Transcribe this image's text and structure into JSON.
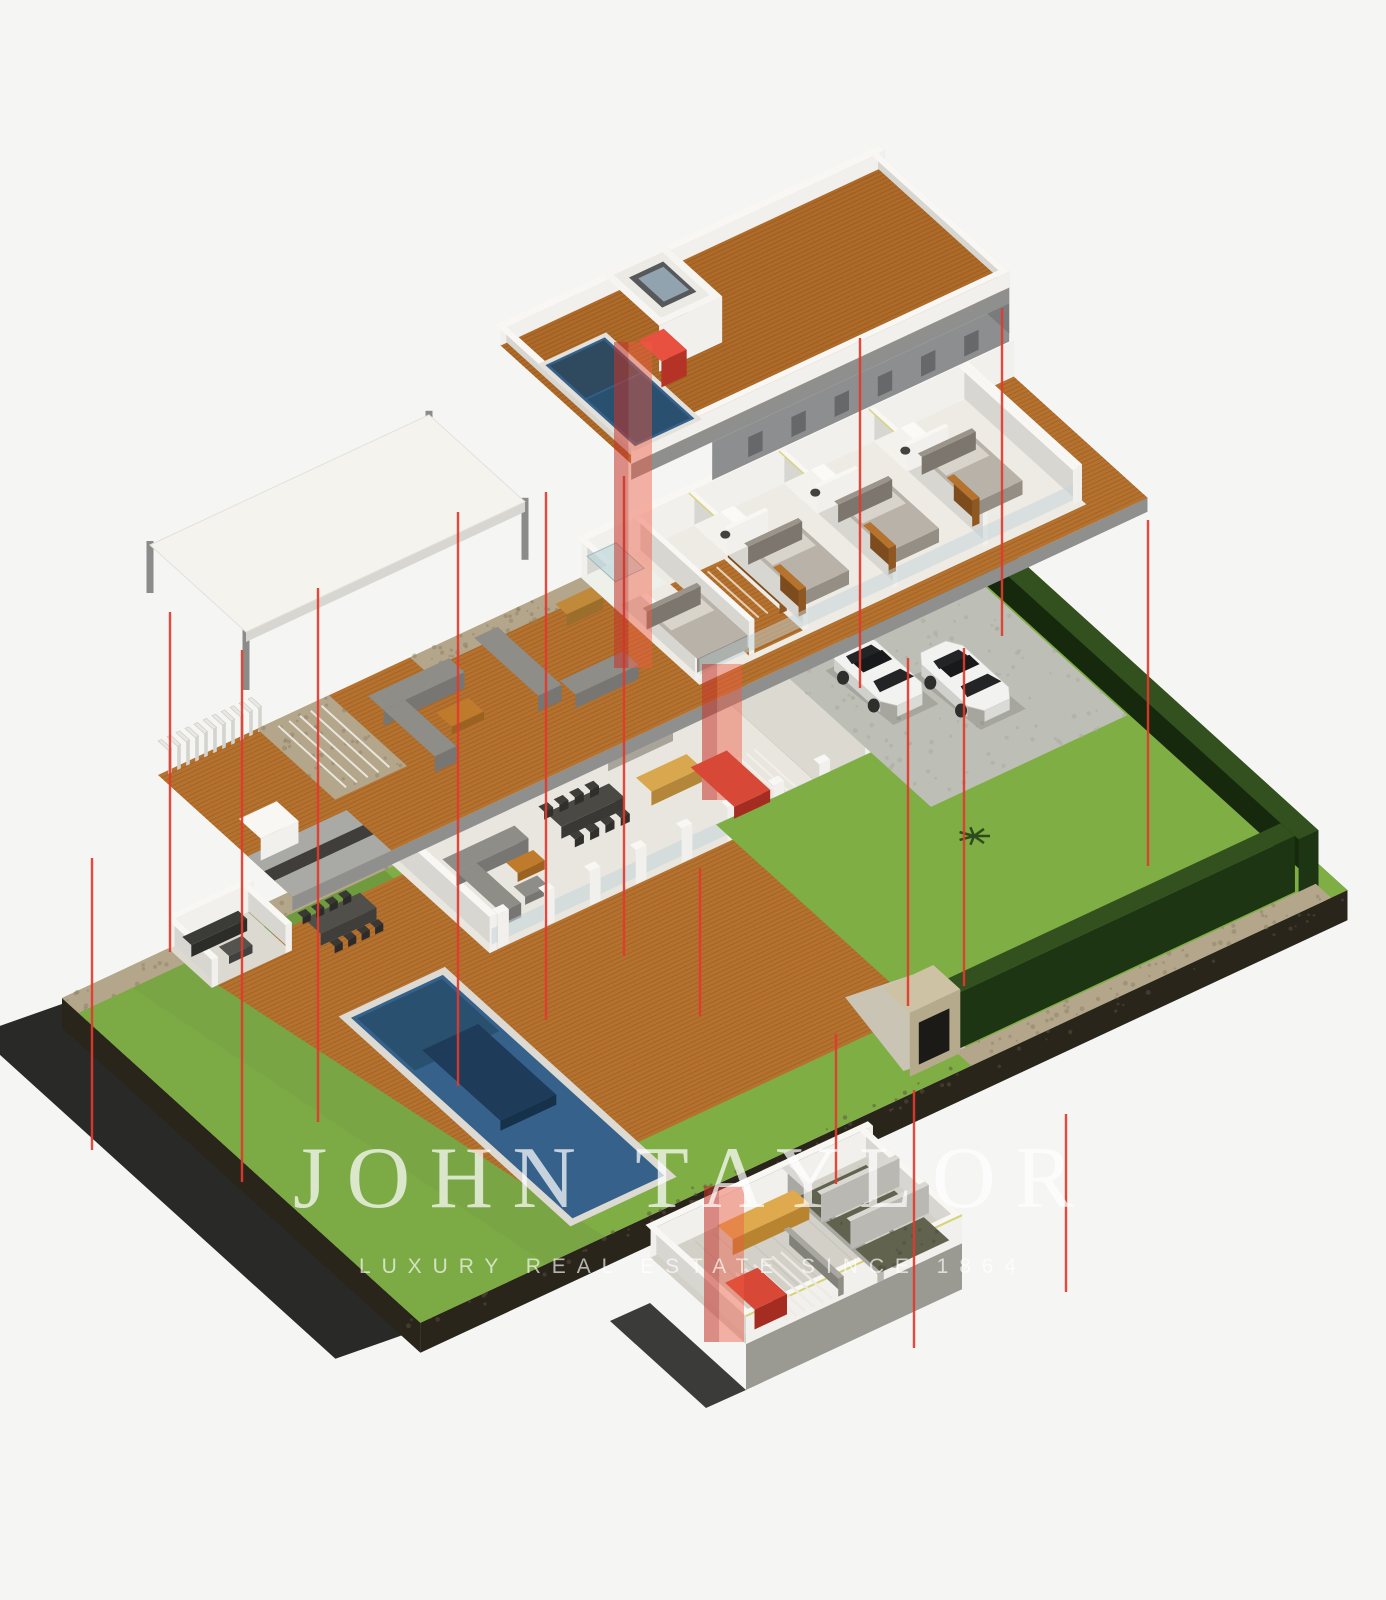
{
  "watermark": {
    "brand": "JOHN TAYLOR",
    "tagline": "LUXURY REAL ESTATE SINCE 1864"
  },
  "colors": {
    "background": "#f5f5f3",
    "red_line": "#e2392b",
    "red_shaft_light": "#ef5a43",
    "red_shaft_dark": "#c5352a",
    "red_box": "#d84836",
    "wood": "#b5722f",
    "wood_plank": "#8a4f1d",
    "roof_wood": "#ad6a28",
    "wood_accent": "#b5732e",
    "pool_water": "#35618a",
    "pool_deep": "#2a5070",
    "lounger_navy": "#1e3c59",
    "grass": "#7fae45",
    "grass_dark": "#6f9a3e",
    "lawn_band": "#79a544",
    "hedge_top": "#33511f",
    "hedge_front": "#1d3512",
    "hedge_side": "#16290d",
    "stone": "#b3a68a",
    "concrete": "#bfc0b7",
    "driveway": "#bdbeb5",
    "wall_white": "#f1f0ec",
    "wall_top": "#f8f7f3",
    "wall_shade": "#d8d6d0",
    "slab_front": "#8f8f8d",
    "slab_right": "#7a7a78",
    "floor_white": "#edebe4",
    "floor_tile": "#e8e6df",
    "gray_furniture": "#8e8d88",
    "dark_furniture": "#4b4944",
    "tan_island": "#d9a84e",
    "orange_table": "#bf7a2c",
    "bench_yellow": "#dfa94d",
    "car_body": "#f2f2f0",
    "car_glass": "#222426",
    "glass_band": "#c3d4d8",
    "shower_glass": "#bcd6da",
    "soil": "#2a251b",
    "shadow": "#0c0c0a",
    "canopy": "#f4f3ee",
    "basement_floor": "#d2d0c7",
    "cell_floor": "#61634f",
    "lime_edge": "#d6d276"
  }
}
